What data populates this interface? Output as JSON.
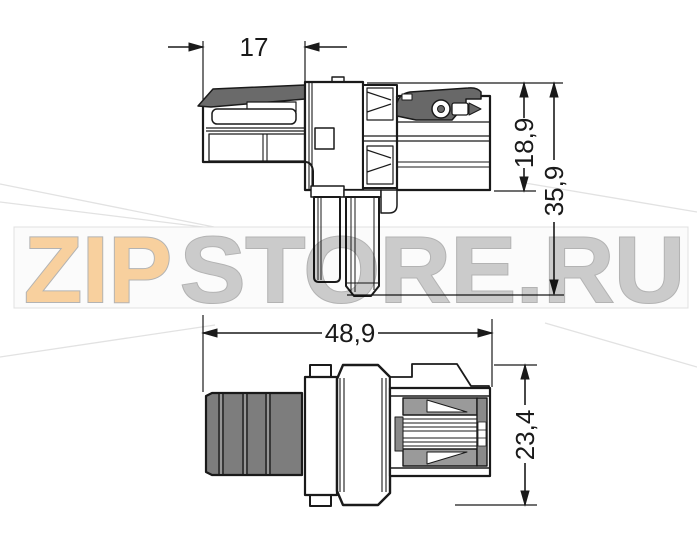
{
  "dimensions": {
    "d17": "17",
    "d18_9": "18,9",
    "d35_9": "35,9",
    "d48_9": "48,9",
    "d23_4": "23,4"
  },
  "watermark": {
    "zip": "ZIP",
    "store": "STORE.RU",
    "zip_color": "#f8d09e",
    "store_color": "#cbcbcb",
    "band_fill": "#fbfbfb",
    "band_border": "#e0e0e0",
    "ray_color": "#e2e2e2"
  },
  "colors": {
    "line": "#1a1a1a",
    "latch_gray": "#686868",
    "strip_gray": "#6a6a6a",
    "rib_gray": "#7d7d7d",
    "contact_gray": "#9a9a9a",
    "side_gray": "#8a8a8a"
  }
}
